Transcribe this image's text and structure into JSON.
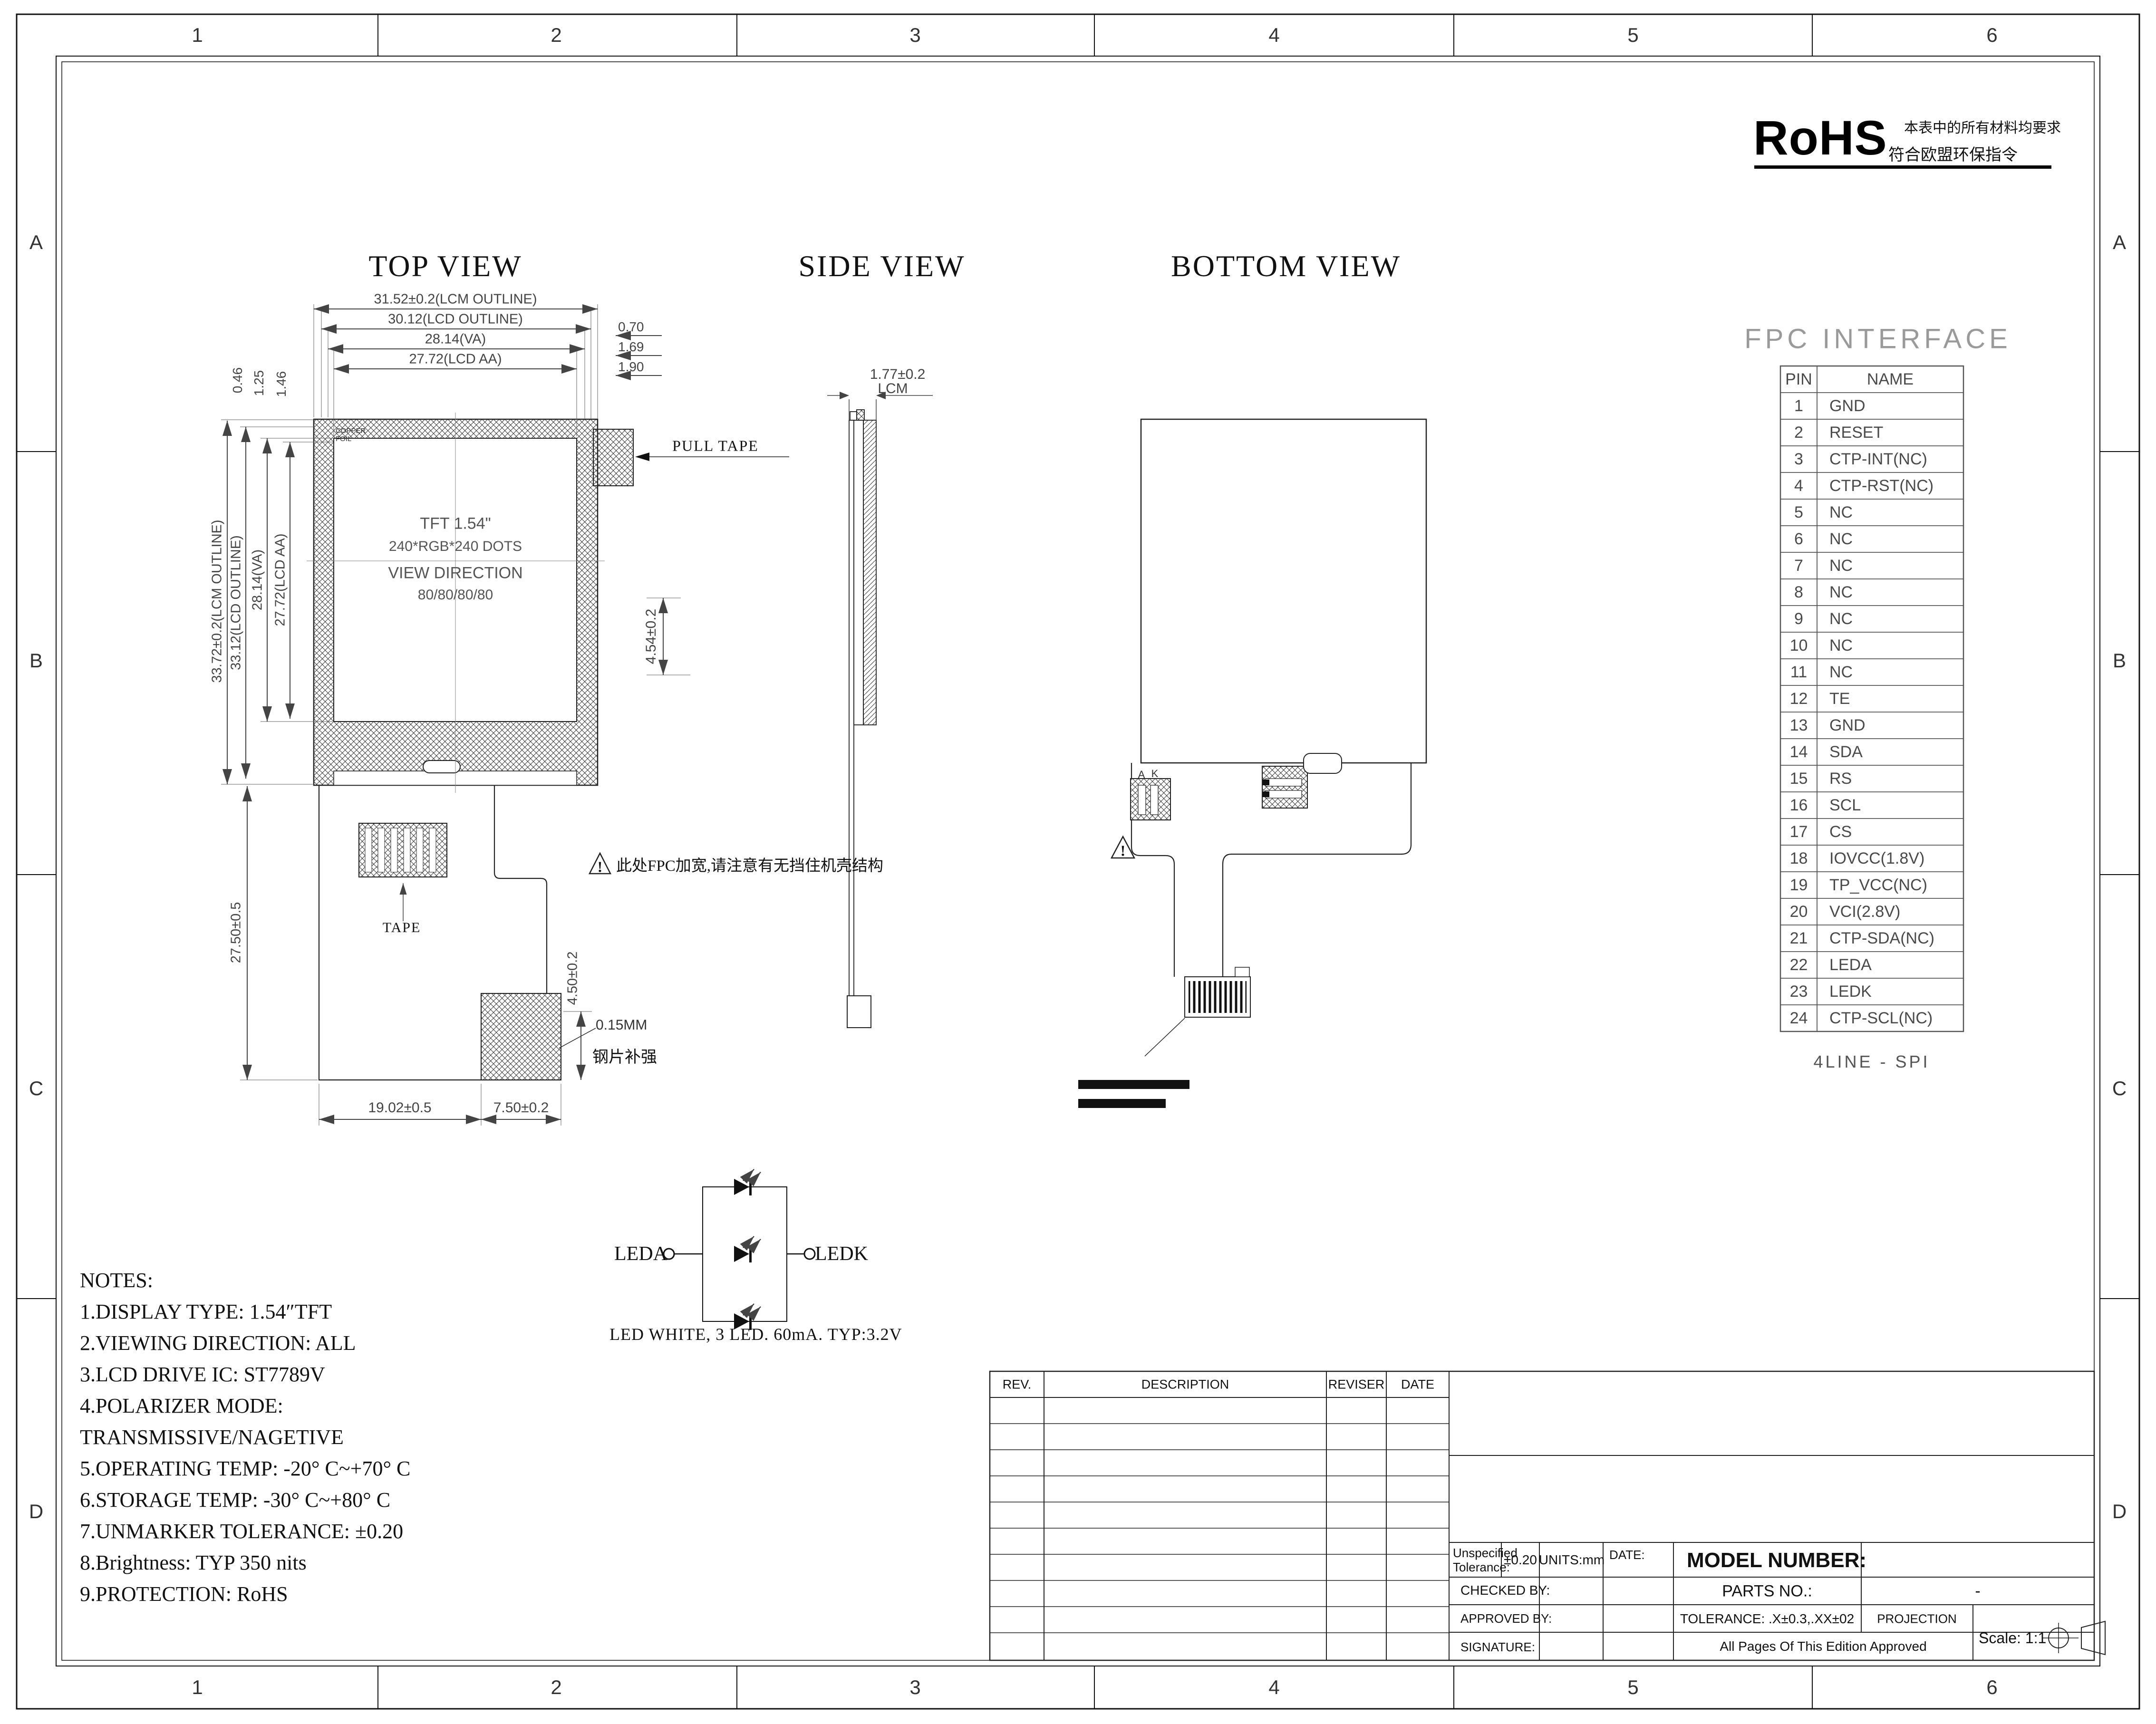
{
  "sheet": {
    "grid_cols": [
      "1",
      "2",
      "3",
      "4",
      "5",
      "6"
    ],
    "grid_rows": [
      "A",
      "B",
      "C",
      "D"
    ]
  },
  "rohs": {
    "logo": "RoHS",
    "line1": "本表中的所有材料均要求",
    "line2": "符合欧盟环保指令"
  },
  "views": {
    "top": "TOP VIEW",
    "side": "SIDE VIEW",
    "bottom": "BOTTOM VIEW"
  },
  "top_view": {
    "dims_top": [
      "31.52±0.2(LCM OUTLINE)",
      "30.12(LCD OUTLINE)",
      "28.14(VA)",
      "27.72(LCD AA)"
    ],
    "dims_top_right": [
      "0.70",
      "1.69",
      "1.90"
    ],
    "dims_left": [
      "33.72±0.2(LCM OUTLINE)",
      "33.12(LCD OUTLINE)",
      "28.14(VA)",
      "27.72(LCD AA)"
    ],
    "dims_left_top": [
      "0.46",
      "1.25",
      "1.46"
    ],
    "display_text": [
      "TFT 1.54\"",
      "240*RGB*240 DOTS",
      "VIEW DIRECTION",
      "80/80/80/80"
    ],
    "copper_foil": "COPPER FOIL",
    "pull_tape": "PULL TAPE",
    "tape": "TAPE",
    "dim_fpc_height": "27.50±0.5",
    "dim_bottom_left": "19.02±0.5",
    "dim_bottom_right": "7.50±0.2",
    "dim_stiffener": "4.50±0.2",
    "stiffener_note_line1": "0.15MM",
    "stiffener_note_line2": "钢片补强",
    "warning_mark": "!",
    "fpc_warning": "此处FPC加宽,请注意有无挡住机壳结构"
  },
  "side_view": {
    "dim_thickness": "1.77±0.2",
    "dim_thickness_label": "LCM",
    "dim_gap": "4.54±0.2"
  },
  "bottom_view": {
    "label_a": "A",
    "label_k": "K",
    "warning_mark": "!"
  },
  "fpc_interface": {
    "title": "FPC INTERFACE",
    "headers": [
      "PIN",
      "NAME"
    ],
    "pins": [
      [
        "1",
        "GND"
      ],
      [
        "2",
        "RESET"
      ],
      [
        "3",
        "CTP-INT(NC)"
      ],
      [
        "4",
        "CTP-RST(NC)"
      ],
      [
        "5",
        "NC"
      ],
      [
        "6",
        "NC"
      ],
      [
        "7",
        "NC"
      ],
      [
        "8",
        "NC"
      ],
      [
        "9",
        "NC"
      ],
      [
        "10",
        "NC"
      ],
      [
        "11",
        "NC"
      ],
      [
        "12",
        "TE"
      ],
      [
        "13",
        "GND"
      ],
      [
        "14",
        "SDA"
      ],
      [
        "15",
        "RS"
      ],
      [
        "16",
        "SCL"
      ],
      [
        "17",
        "CS"
      ],
      [
        "18",
        "IOVCC(1.8V)"
      ],
      [
        "19",
        "TP_VCC(NC)"
      ],
      [
        "20",
        "VCI(2.8V)"
      ],
      [
        "21",
        "CTP-SDA(NC)"
      ],
      [
        "22",
        "LEDA"
      ],
      [
        "23",
        "LEDK"
      ],
      [
        "24",
        "CTP-SCL(NC)"
      ]
    ],
    "footer": "4LINE - SPI"
  },
  "led_diagram": {
    "anode": "LEDA",
    "cathode": "LEDK",
    "caption": "LED WHITE, 3 LED. 60mA. TYP:3.2V"
  },
  "notes": {
    "lines": [
      "NOTES:",
      "1.DISPLAY TYPE:  1.54″TFT",
      "2.VIEWING DIRECTION: ALL",
      "3.LCD DRIVE IC: ST7789V",
      "4.POLARIZER MODE:",
      "TRANSMISSIVE/NAGETIVE",
      "5.OPERATING TEMP: -20° C~+70° C",
      "6.STORAGE TEMP: -30° C~+80° C",
      "7.UNMARKER TOLERANCE: ±0.20",
      "8.Brightness: TYP 350 nits",
      "9.PROTECTION: RoHS"
    ]
  },
  "revision_table": {
    "headers": [
      "REV.",
      "DESCRIPTION",
      "REVISER",
      "DATE"
    ]
  },
  "title_block": {
    "unspecified_label_1": "Unspecified",
    "unspecified_label_2": "Tolerance:",
    "unspecified_value": "±0.20",
    "units": "UNITS:mm",
    "date_label": "DATE:",
    "model_number": "MODEL NUMBER:",
    "checked_by": "CHECKED BY:",
    "parts_no": "PARTS NO.:",
    "parts_no_value": "-",
    "approved_by": "APPROVED BY:",
    "tolerance": "TOLERANCE:  .X±0.3,.XX±02",
    "projection": "PROJECTION",
    "signature": "SIGNATURE:",
    "edition_note": "All Pages Of This Edition Approved",
    "scale": "Scale: 1:1"
  }
}
